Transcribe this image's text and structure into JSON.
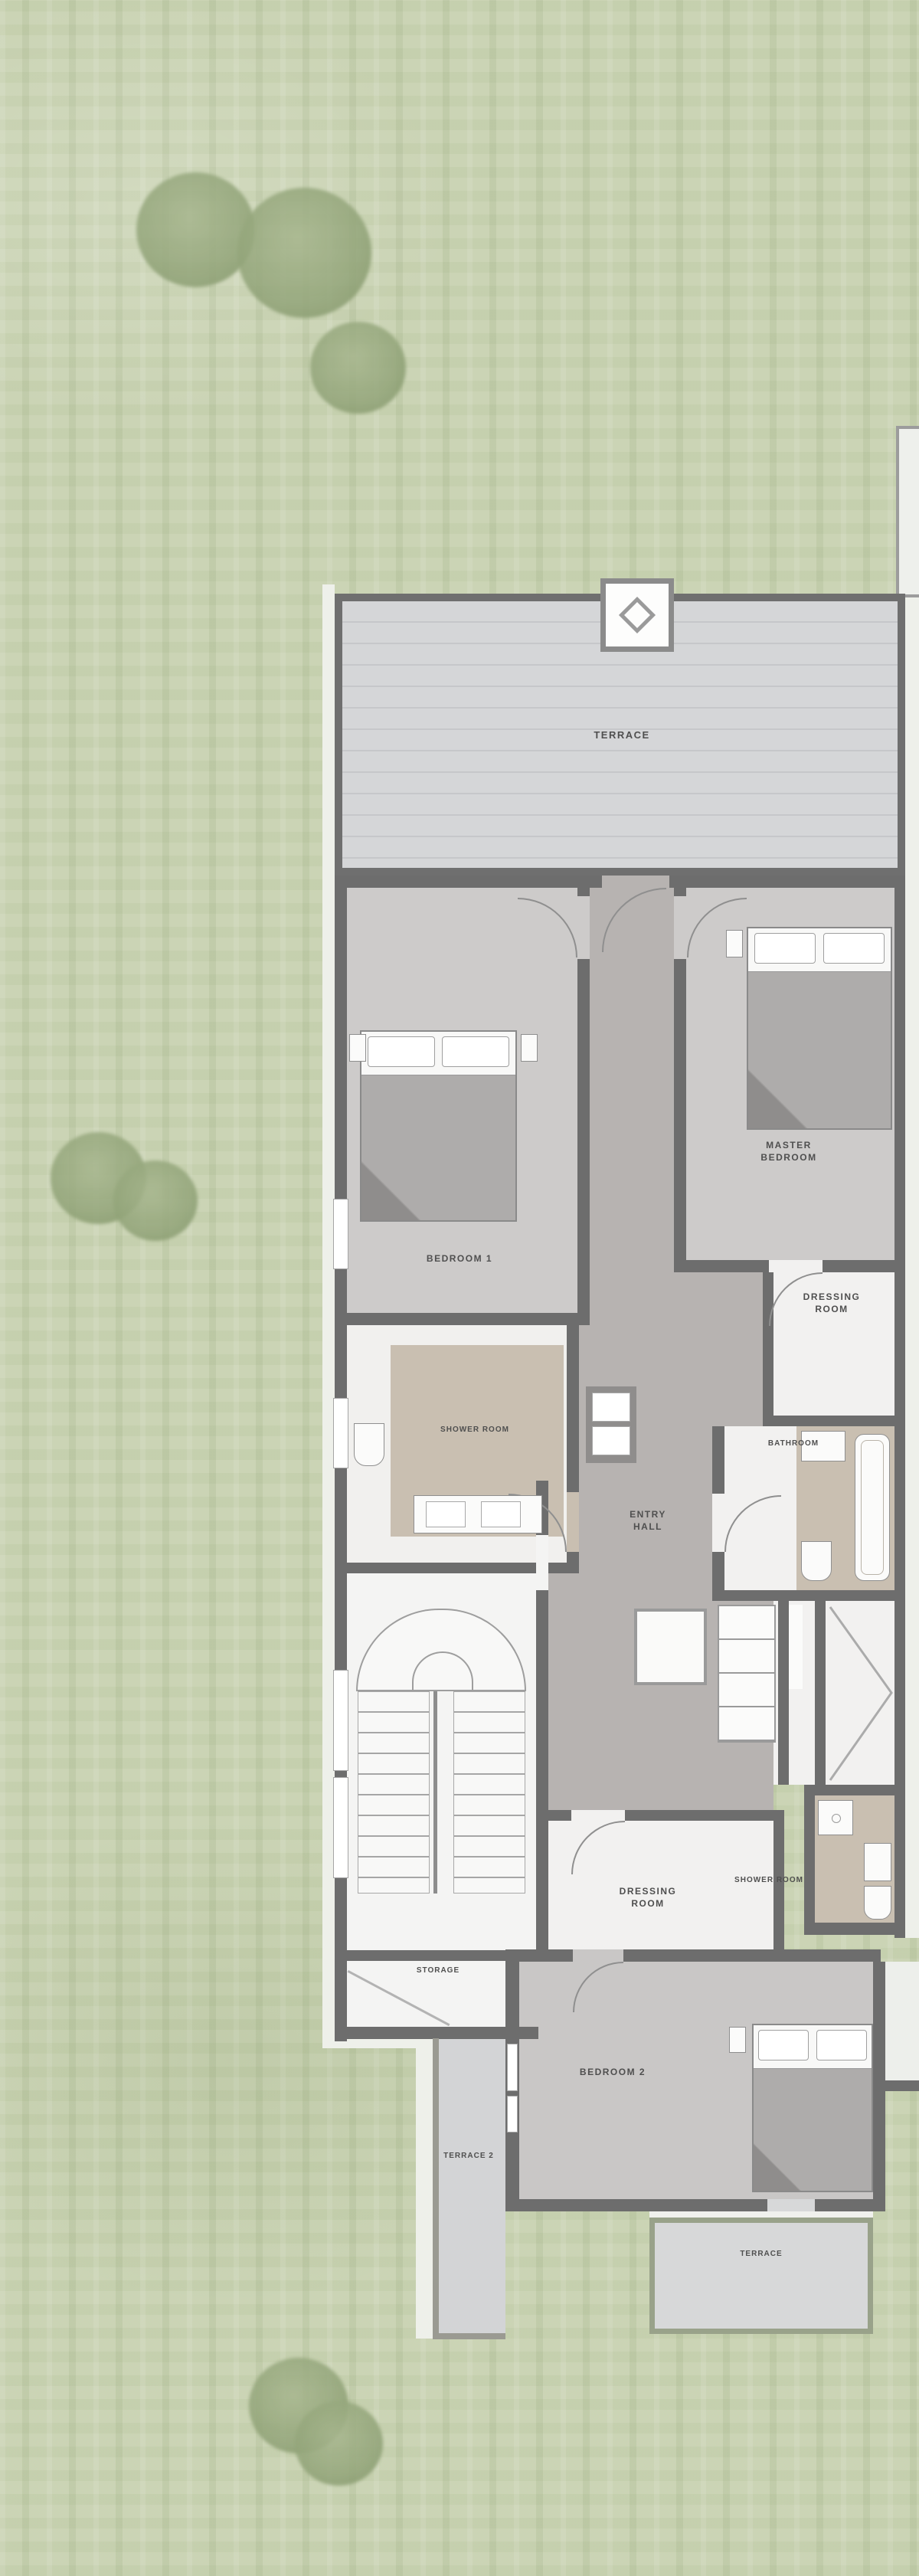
{
  "scene": {
    "type": "architectural floor plan, top-down view on lawn",
    "floor_level": "upper floor with terraces, bedrooms and stair"
  },
  "plan": {
    "rooms": {
      "terrace_top": {
        "label": "TERRACE"
      },
      "bedroom_1": {
        "label": "BEDROOM 1"
      },
      "master_bedroom": {
        "line1": "MASTER",
        "line2": "BEDROOM"
      },
      "dressing_room_1": {
        "line1": "DRESSING",
        "line2": "ROOM"
      },
      "bathroom": {
        "label": "BATHROOM"
      },
      "shower_room_1": {
        "label": "SHOWER ROOM"
      },
      "entry_hall": {
        "line1": "ENTRY",
        "line2": "HALL"
      },
      "shower_room_2": {
        "label": "SHOWER ROOM"
      },
      "dressing_room_2": {
        "line1": "DRESSING",
        "line2": "ROOM"
      },
      "storage": {
        "label": "STORAGE"
      },
      "bedroom_2": {
        "label": "BEDROOM 2"
      },
      "terrace_2": {
        "label": "TERRACE 2"
      },
      "terrace_bottom": {
        "label": "TERRACE"
      }
    },
    "colors": {
      "grass": "#c8d2b1",
      "tree": "#97a87e",
      "wall": "#6d6d6d",
      "deck_floor": "#d4d5d7",
      "bedroom_floor": "#cdcbca",
      "hall_floor": "#b7b3b1",
      "wet_room_floor": "#c9bfb1",
      "white_floor": "#f2f1f0",
      "terrace_border": "#99a28a",
      "label_text": "#4f4f4f"
    }
  }
}
